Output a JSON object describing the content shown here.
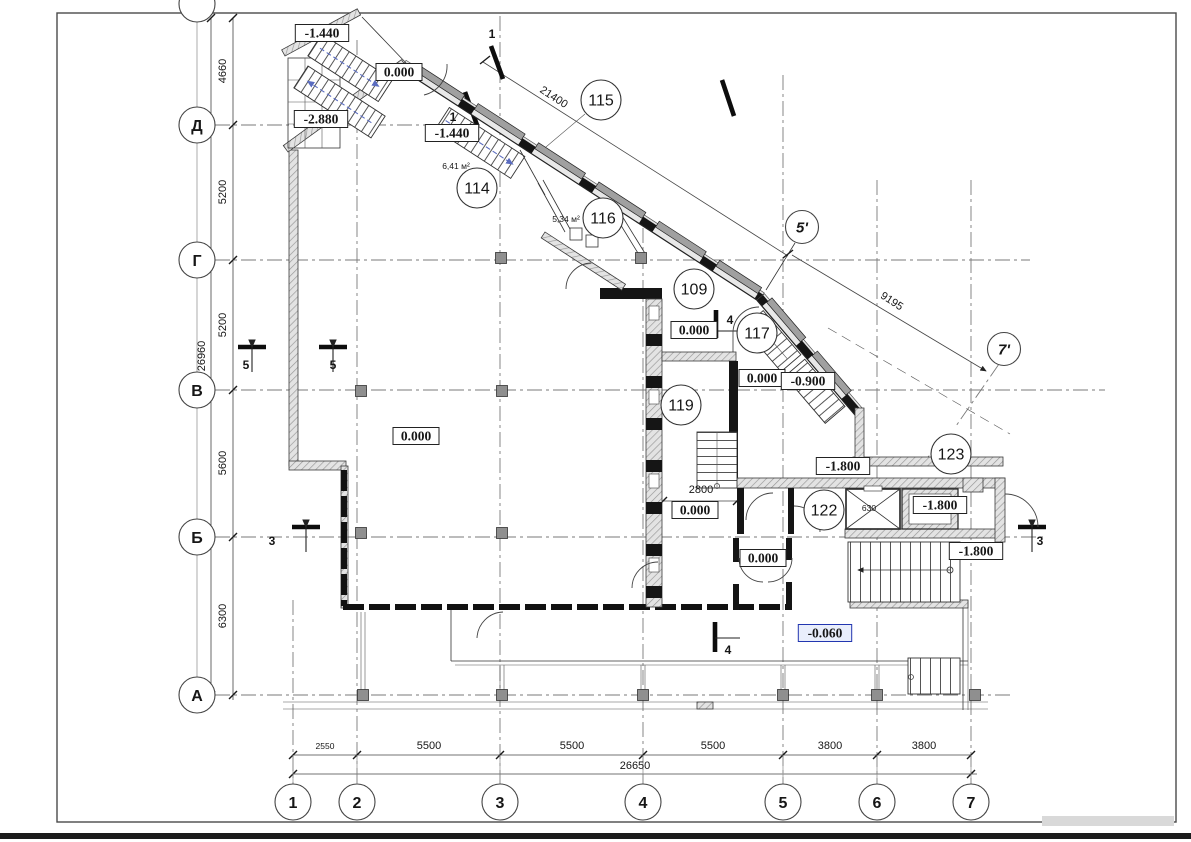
{
  "colors": {
    "accent_blue": "#2236b0",
    "accent_blue_bg": "#e9eefb",
    "line": "#1a1a1a",
    "grid": "#7a7a7a",
    "stair_arrow": "#5a6cc0"
  },
  "axis_bubbles": {
    "rows": [
      {
        "label": "Д",
        "cx": 197,
        "cy": 125
      },
      {
        "label": "Г",
        "cx": 197,
        "cy": 260
      },
      {
        "label": "В",
        "cx": 197,
        "cy": 390
      },
      {
        "label": "Б",
        "cx": 197,
        "cy": 537
      },
      {
        "label": "А",
        "cx": 197,
        "cy": 695
      }
    ],
    "cols": [
      {
        "label": "1",
        "cx": 293,
        "cy": 802
      },
      {
        "label": "2",
        "cx": 357,
        "cy": 802
      },
      {
        "label": "3",
        "cx": 500,
        "cy": 802
      },
      {
        "label": "4",
        "cx": 643,
        "cy": 802
      },
      {
        "label": "5",
        "cx": 783,
        "cy": 802
      },
      {
        "label": "6",
        "cx": 877,
        "cy": 802
      },
      {
        "label": "7",
        "cx": 971,
        "cy": 802
      }
    ],
    "aux": [
      {
        "label": "5'",
        "cx": 802,
        "cy": 227
      },
      {
        "label": "7'",
        "cx": 1004,
        "cy": 349
      }
    ],
    "partial_top": {
      "cx": 197,
      "cy": 4
    }
  },
  "room_tags": [
    {
      "number": "115",
      "cx": 601,
      "cy": 100
    },
    {
      "number": "114",
      "cx": 477,
      "cy": 188
    },
    {
      "number": "116",
      "cx": 603,
      "cy": 218
    },
    {
      "number": "109",
      "cx": 694,
      "cy": 289
    },
    {
      "number": "117",
      "cx": 757,
      "cy": 333
    },
    {
      "number": "119",
      "cx": 681,
      "cy": 405
    },
    {
      "number": "122",
      "cx": 824,
      "cy": 510
    },
    {
      "number": "123",
      "cx": 951,
      "cy": 454
    }
  ],
  "area_labels": [
    {
      "text": "6,41 м²",
      "x": 456,
      "y": 169
    },
    {
      "text": "5,34 м²",
      "x": 566,
      "y": 222
    }
  ],
  "elevation_marks": [
    {
      "text": "-1.440",
      "cx": 322,
      "cy": 33
    },
    {
      "text": "0.000",
      "cx": 399,
      "cy": 72
    },
    {
      "text": "-2.880",
      "cx": 321,
      "cy": 119
    },
    {
      "text": "-1.440",
      "cx": 452,
      "cy": 133
    },
    {
      "text": "0.000",
      "cx": 694,
      "cy": 330
    },
    {
      "text": "0.000",
      "cx": 762,
      "cy": 378
    },
    {
      "text": "-0.900",
      "cx": 808,
      "cy": 381
    },
    {
      "text": "0.000",
      "cx": 416,
      "cy": 436
    },
    {
      "text": "-1.800",
      "cx": 843,
      "cy": 466
    },
    {
      "text": "-1.800",
      "cx": 940,
      "cy": 505
    },
    {
      "text": "0.000",
      "cx": 695,
      "cy": 510
    },
    {
      "text": "-1.800",
      "cx": 976,
      "cy": 551
    },
    {
      "text": "0.000",
      "cx": 763,
      "cy": 558
    },
    {
      "text": "-0.060",
      "cx": 825,
      "cy": 633,
      "accent": true
    }
  ],
  "dimensions": {
    "left": [
      {
        "text": "4660",
        "x": 226,
        "y": 71,
        "rot": -90
      },
      {
        "text": "5200",
        "x": 226,
        "y": 192,
        "rot": -90
      },
      {
        "text": "5200",
        "x": 226,
        "y": 325,
        "rot": -90
      },
      {
        "text": "5600",
        "x": 226,
        "y": 463,
        "rot": -90
      },
      {
        "text": "6300",
        "x": 226,
        "y": 616,
        "rot": -90
      },
      {
        "text": "26960",
        "x": 205,
        "y": 356,
        "rot": -90
      }
    ],
    "bottom": [
      {
        "text": "2550",
        "x": 325,
        "y": 749,
        "small": true
      },
      {
        "text": "5500",
        "x": 429,
        "y": 749
      },
      {
        "text": "5500",
        "x": 572,
        "y": 749
      },
      {
        "text": "5500",
        "x": 713,
        "y": 749
      },
      {
        "text": "3800",
        "x": 830,
        "y": 749
      },
      {
        "text": "3800",
        "x": 924,
        "y": 749
      },
      {
        "text": "26650",
        "x": 635,
        "y": 769
      }
    ],
    "diagonal": [
      {
        "text": "21400",
        "x": 552,
        "y": 100,
        "rot": 33
      },
      {
        "text": "9195",
        "x": 890,
        "y": 304,
        "rot": 33
      }
    ],
    "interior": [
      {
        "text": "2800",
        "x": 701,
        "y": 493
      },
      {
        "text": "630",
        "x": 869,
        "y": 511,
        "small": true
      }
    ]
  },
  "section_marks": [
    {
      "text": "1",
      "x": 492,
      "y": 38
    },
    {
      "text": "1",
      "x": 453,
      "y": 121
    },
    {
      "text": "5",
      "x": 246,
      "y": 369
    },
    {
      "text": "5",
      "x": 333,
      "y": 369
    },
    {
      "text": "3",
      "x": 272,
      "y": 545
    },
    {
      "text": "3",
      "x": 1040,
      "y": 545
    },
    {
      "text": "4",
      "x": 730,
      "y": 324
    },
    {
      "text": "4",
      "x": 728,
      "y": 654
    }
  ]
}
